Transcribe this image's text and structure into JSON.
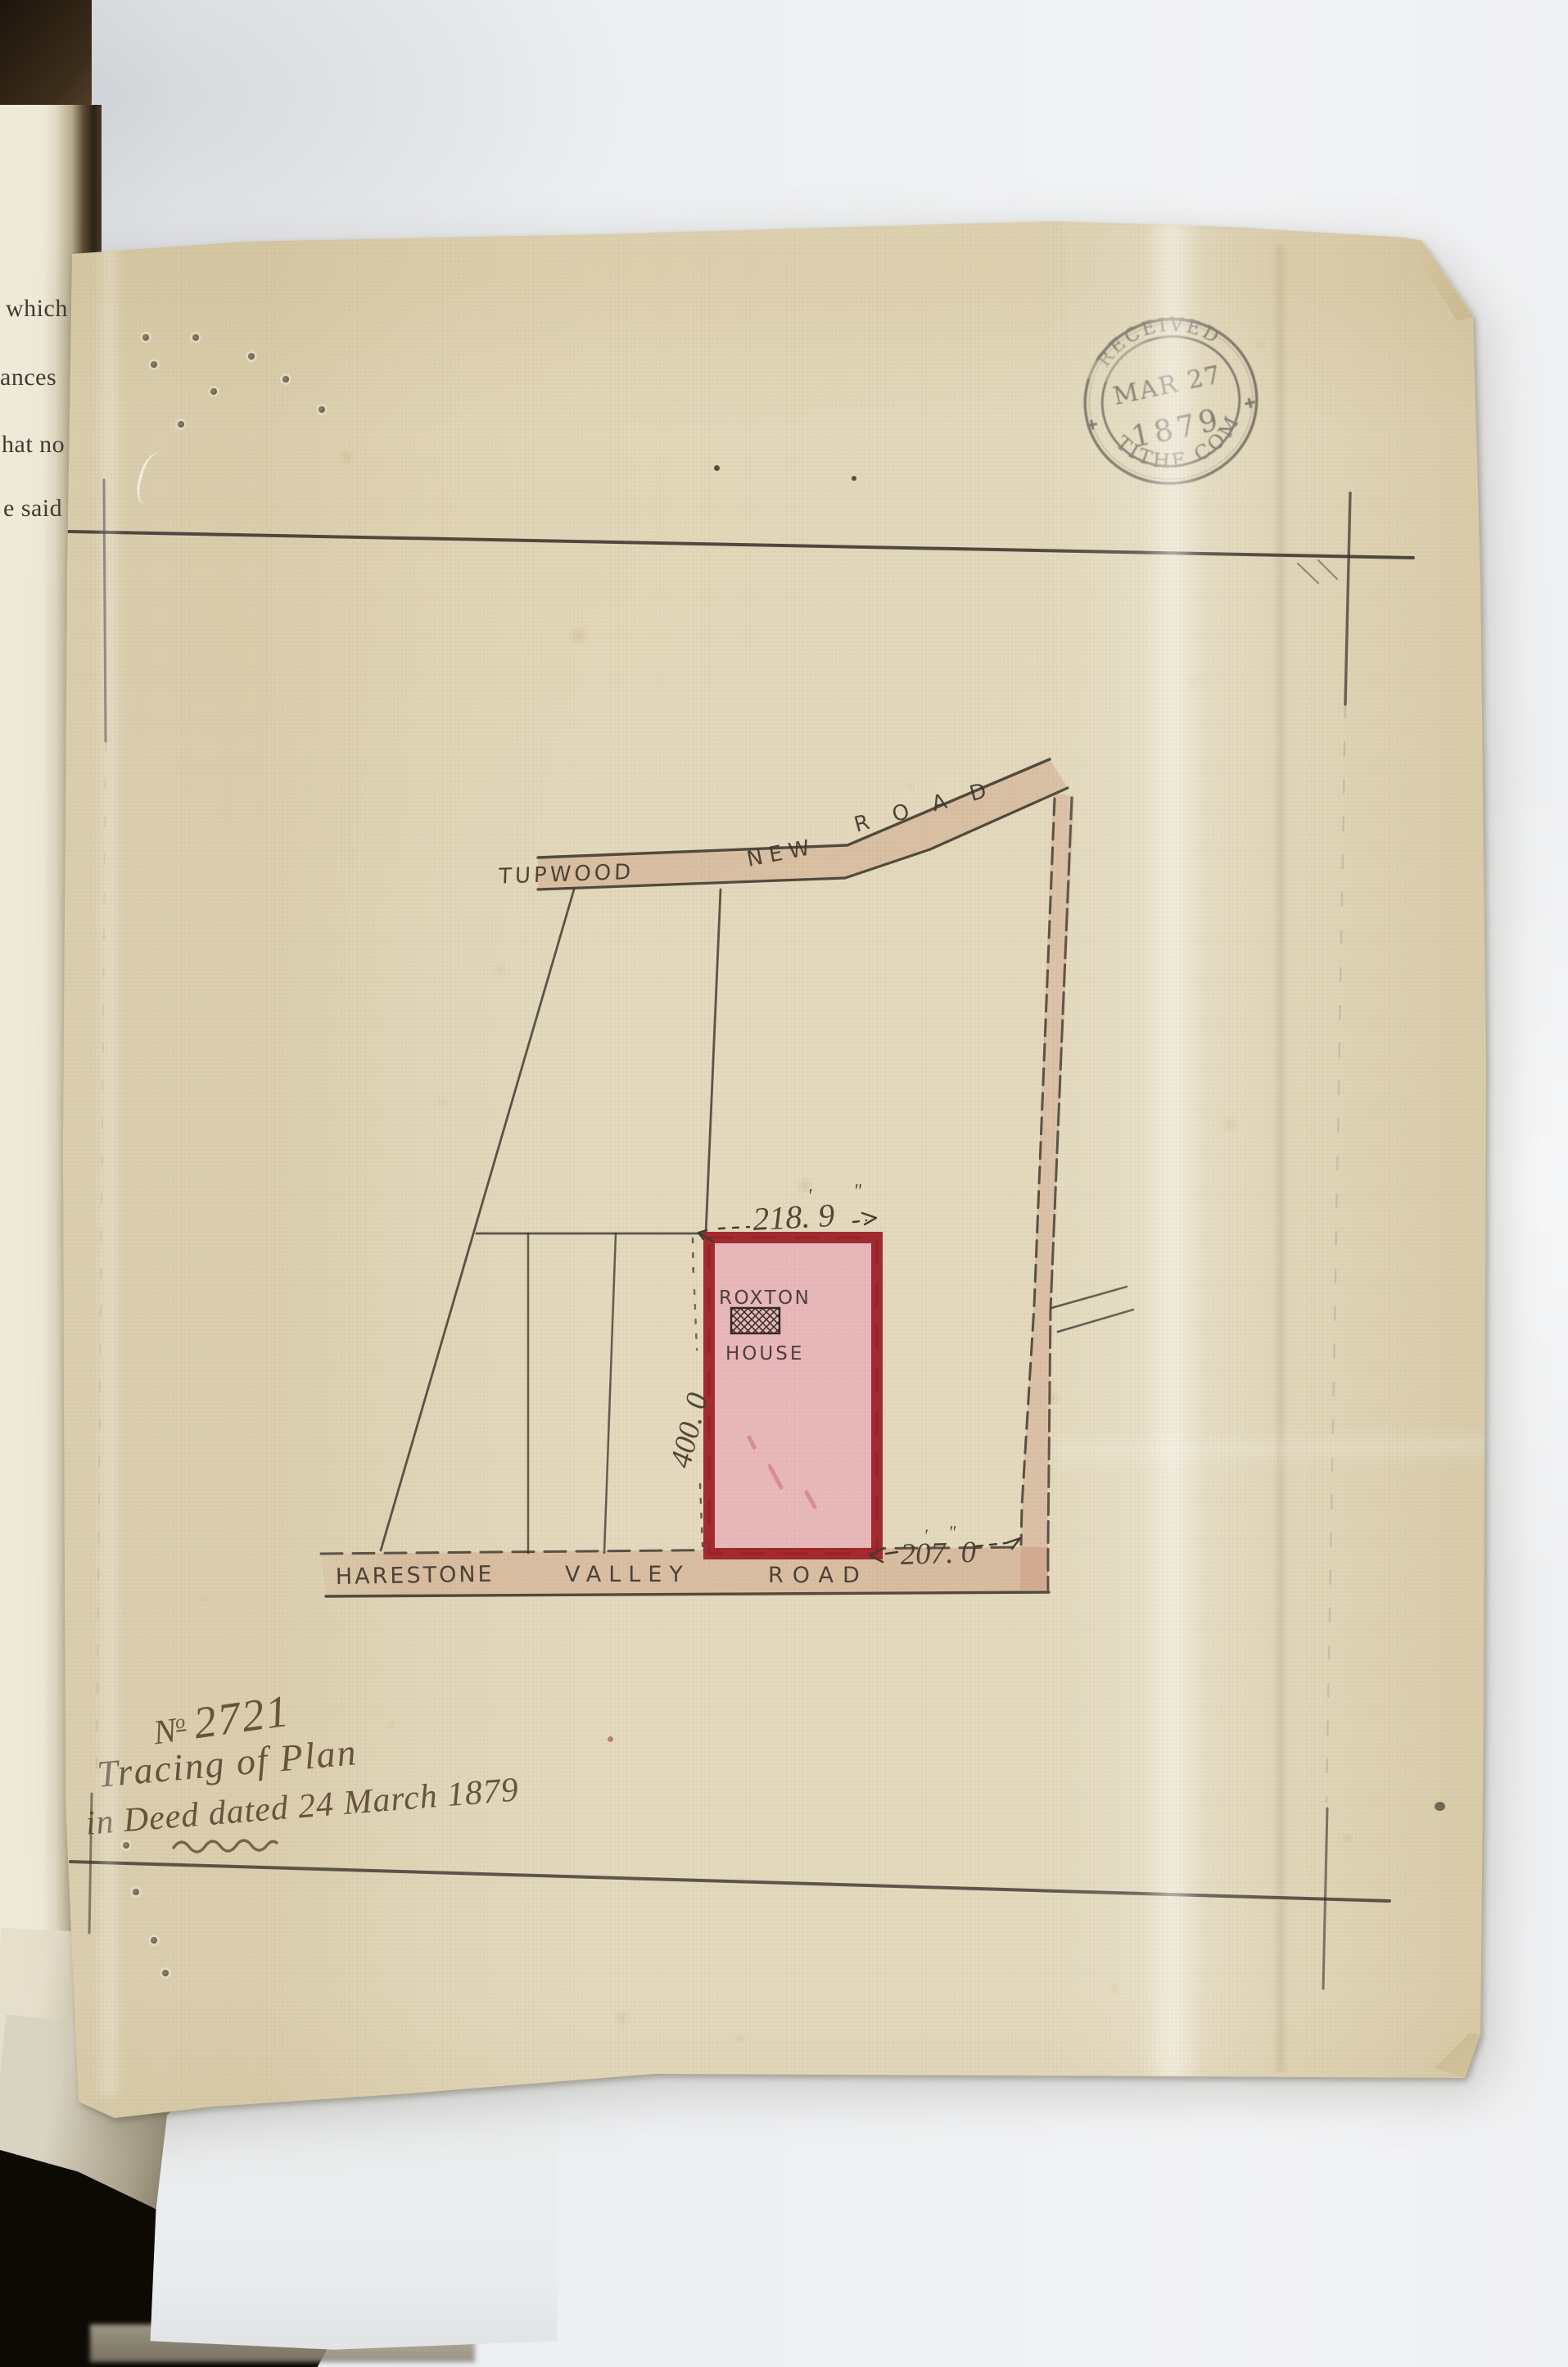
{
  "book": {
    "fragments": {
      "f1": "which",
      "f2": "ances",
      "f3": "hat no",
      "f4": "e said"
    }
  },
  "stamp": {
    "top": "RECEIVED",
    "line1": "MAR 27",
    "line2": "1879",
    "bottom": "TITHE COM"
  },
  "plan": {
    "road_top": {
      "w1": "TUPWOOD",
      "w2": "NEW",
      "w3": "ROAD"
    },
    "road_bottom": {
      "w1": "HARESTONE",
      "w2": "VALLEY",
      "w3": "ROAD"
    },
    "plot": {
      "l1": "ROXTON",
      "l2": "HOUSE"
    },
    "dims": {
      "top": "218. 9",
      "left": "400. 0",
      "bottom": "207. 0"
    },
    "marks": {
      "feet": "'",
      "inches": "\""
    }
  },
  "annotation": {
    "no_prefix": "N",
    "no_sup": "o",
    "no_value": "2721",
    "line2": "Tracing of Plan",
    "line3": "in Deed dated 24 March 1879"
  },
  "colors": {
    "paper": "#e4dabe",
    "ink": "#38322a",
    "plot_border": "#a2232b",
    "plot_fill": "#eab7bb",
    "road_wash": "#c4836a",
    "stamp_ink": "#55504a",
    "writing_ink": "#5c4a33",
    "backing": "#eef0f2"
  }
}
